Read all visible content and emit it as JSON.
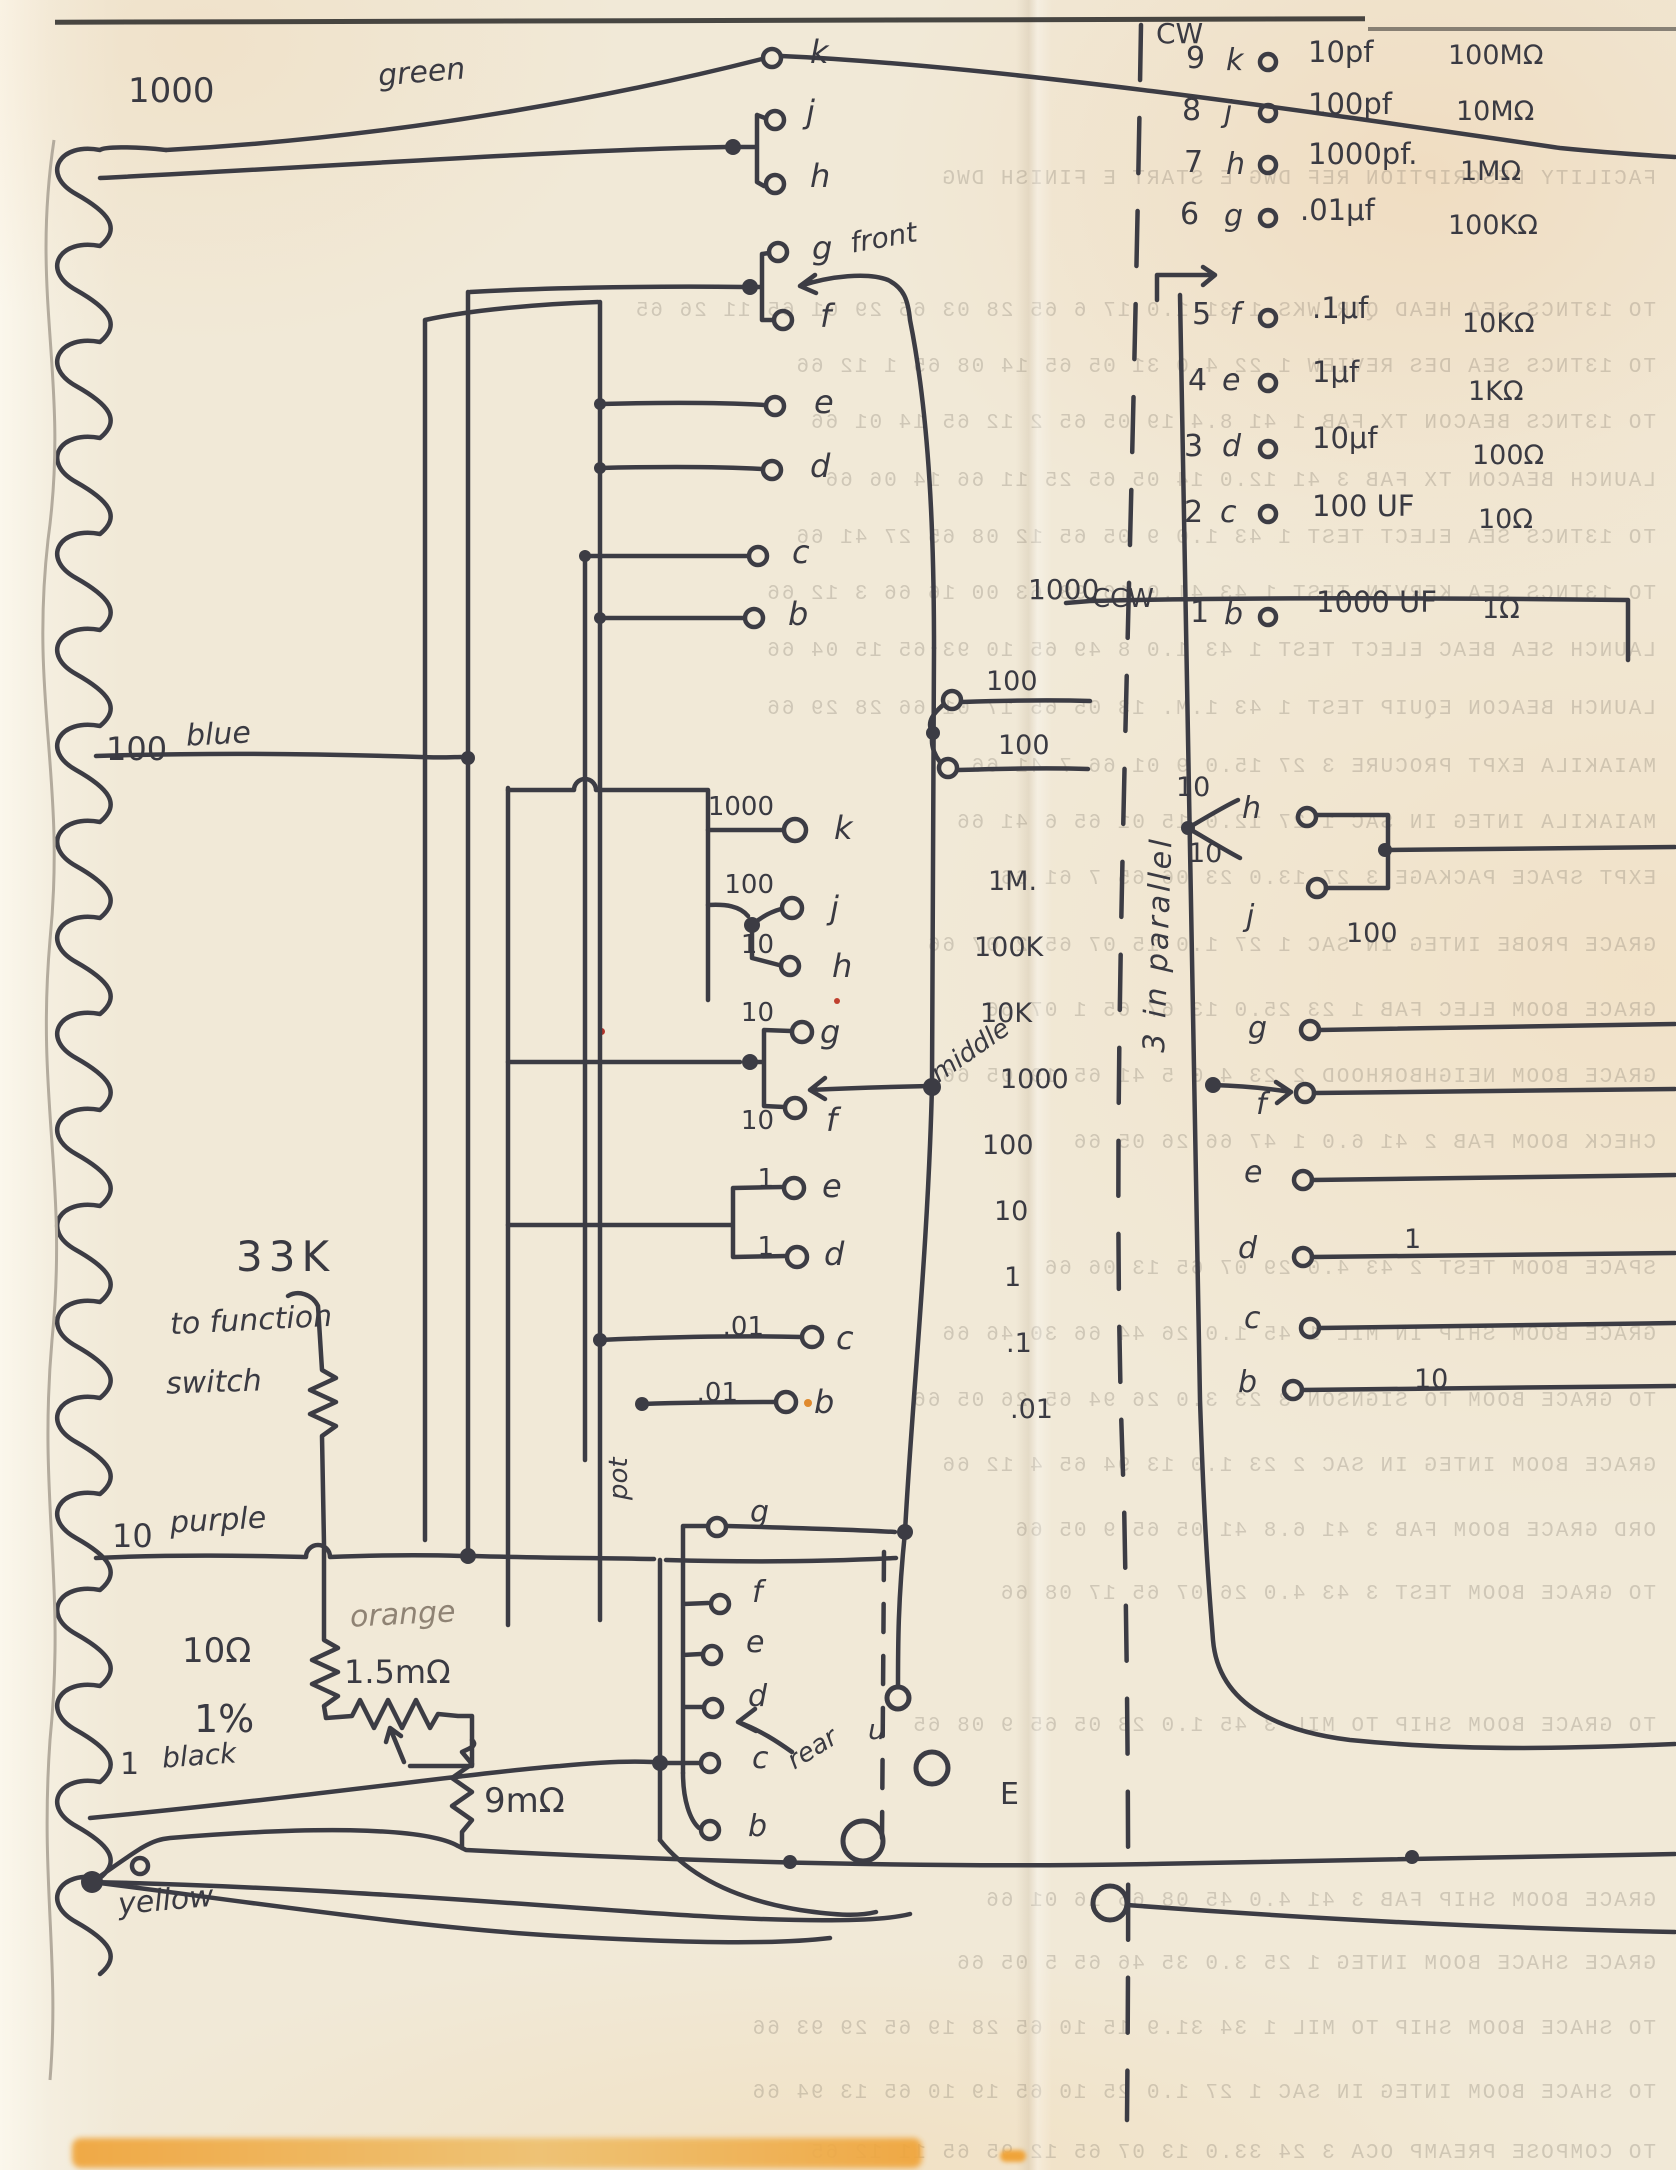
{
  "colors": {
    "ink": "#3c3c44",
    "pencil": "#8f8374",
    "paper": "#f1e9d7",
    "stain": "#efa43a",
    "speck_red": "#b5342a"
  },
  "transformer": {
    "taps": [
      {
        "value": "1000",
        "wire": "green"
      },
      {
        "value": "100",
        "wire": "blue"
      },
      {
        "value": "10",
        "wire": "purple"
      },
      {
        "value": "1",
        "wire": "black"
      },
      {
        "value": "",
        "wire": "yellow"
      }
    ]
  },
  "notes": {
    "cw": "CW",
    "ccw": "CCW",
    "parallel_note": "3 in parallel",
    "wiper_front": "front",
    "wiper_middle": "middle",
    "wiper_rear": "rear",
    "pot": "pot",
    "function_value": "33K",
    "function_line1": "to function",
    "function_line2": "switch",
    "precision_value": "10Ω",
    "precision_tol": "1%",
    "range_value": "1.5mΩ",
    "shunt_value": "9mΩ",
    "orange_wire": "orange",
    "terminal_u": "u",
    "terminal_E": "E"
  },
  "ladder": {
    "values": [
      "1M.",
      "100K",
      "10K",
      "1000",
      "100",
      "10",
      "1",
      ".1",
      ".01"
    ]
  },
  "wafer1": {
    "letters": [
      "k",
      "j",
      "h",
      "g",
      "f",
      "e",
      "d",
      "c",
      "b"
    ]
  },
  "wafer2": {
    "rows": [
      {
        "v": "1000",
        "l": "k"
      },
      {
        "v": "100",
        "l": "j"
      },
      {
        "v": "10",
        "l": "h"
      },
      {
        "v": "10",
        "l": "g"
      },
      {
        "v": "10",
        "l": "f"
      },
      {
        "v": "1",
        "l": "e"
      },
      {
        "v": "1",
        "l": "d"
      },
      {
        "v": ".01",
        "l": "c"
      },
      {
        "v": ".01",
        "l": "b"
      }
    ]
  },
  "wafer3": {
    "letters": [
      "g",
      "f",
      "e",
      "d",
      "c",
      "b"
    ]
  },
  "decade": {
    "rows": [
      {
        "n": "9",
        "l": "k",
        "cap": "10pf",
        "res": "100MΩ"
      },
      {
        "n": "8",
        "l": "j",
        "cap": "100pf",
        "res": "10MΩ"
      },
      {
        "n": "7",
        "l": "h",
        "cap": "1000pf.",
        "res": "1MΩ"
      },
      {
        "n": "6",
        "l": "g",
        "cap": ".01μf",
        "res": "100KΩ"
      },
      {
        "n": "5",
        "l": "f",
        "cap": ".1μf",
        "res": "10KΩ"
      },
      {
        "n": "4",
        "l": "e",
        "cap": "1μf",
        "res": "1KΩ"
      },
      {
        "n": "3",
        "l": "d",
        "cap": "10μf",
        "res": "100Ω"
      },
      {
        "n": "2",
        "l": "c",
        "cap": "100 UF",
        "res": "10Ω"
      },
      {
        "n": "1",
        "l": "b",
        "cap": "1000 UF",
        "res": "1Ω"
      }
    ]
  },
  "right_switch": {
    "letters": [
      "h",
      "j",
      "g",
      "f",
      "e",
      "d",
      "c",
      "b"
    ],
    "values": {
      "top": "1000",
      "pair100a": "100",
      "pair100b": "100",
      "pair10a": "10",
      "pair10b": "10",
      "wire100": "100",
      "wire1": "1",
      "wire10": "10"
    }
  },
  "bleedthrough": {
    "lines": [
      "FACILITY DESCRIPTION      REF   DWG    E START    E FINISH    DWG",
      "TO 13TNCS SEA HEAD QTR WKS   1 31   1.0   17 6 65   28 03 65   29 01 65   11 26 65",
      "TO 13TNCS SEA DES REVIEW   1 22   4.0   31 05 65   14 08 65   1 12 66",
      "TO 13TNCS BEACON TX FAB   1 41   8.4   19 05 65   2 12 65   14 01 66",
      "LAUNCH BEACON TX FAB   3 41   12.0   14 05 65   25 11 66   14 06 66",
      "TO 13TNCS SEA ELECT TEST   1 43   1.0   9 05 65   12 08 65   27 41 66",
      "TO 13TNCS SEA KERVIN TEST   1 43   41.0   16 98 63   00 16 66   3 12 66",
      "LAUNCH SEA BEAC ELECT TEST   1 43   1.0   8 49 65   10 93 65   15 04 66",
      "LAUNCH BEACON EQUIP TEST   1 43   1.M.   13 05 65   17 01 66   28 29 66",
      "MAIAKILA EXPT PROCURE   3 27   15.0   9 01 66   7 41 66",
      "MAIAKILA INTEG IN SAC   1 27   12.0   15 01 65   6 41 66",
      "EXPT SPACE PACKAGE   3 27   13.0   23 06 65   7 61 66",
      "GRACE PROBE INTEG IN SAC   1 27   1.0   15 07 65   2 07 66",
      "GRACE BOOM ELEC FAB   1 23   25.0   13 67 65   1 07 66",
      "GRACE BOOM NEIGHBORHOOD   2 23   4.0   5 41 65   19 05 66",
      "CHECK BOOM FAB   2 41   6.0   1 47 66   26 05 66",
      "SPACE BOOM TEST   2 43   4.0   29 07 65   13 06 66",
      "GRACE BOOM SHIP IN MIL   1 45   1.0   26 44 66   30 46 66",
      "TO GRACE BOOM TO SIGNSON   3 23   3.0   26 94 65   26 05 66",
      "GRACE BOOM INTEG IN SAC   2 23   1.0   13 94 65   4 12 66",
      "ORD GRACE BOOM FAB   3 41   6.8   41 05 65   9 05 66",
      "TO GRACE BOOM TEST   3 43   4.0   26 07 65   17 08 66",
      "TO GRACE BOOM SHIP TO MIL   3 45   1.0   23 05 65   9 08 65",
      "GRACE BOOM SHIP FAB   3 41   4.0   45 08 65   16 01 66",
      "GRACE SHACE BOOM INTEG   1 25   3.0   35 46 65   5 05 66",
      "TO SHACE BOOM SHIP TO MIL   1 34   31.9   15 10 65   28 19 65   29 93 66",
      "TO SHACE BOOM INTEG IN SAC   1 27   1.0   25 10 65   19 10 65   13 94 66",
      "TO COMPOSE PREAMP OCA   3 24   33.0   13 07 65   12 95 65   11 12 65"
    ]
  }
}
